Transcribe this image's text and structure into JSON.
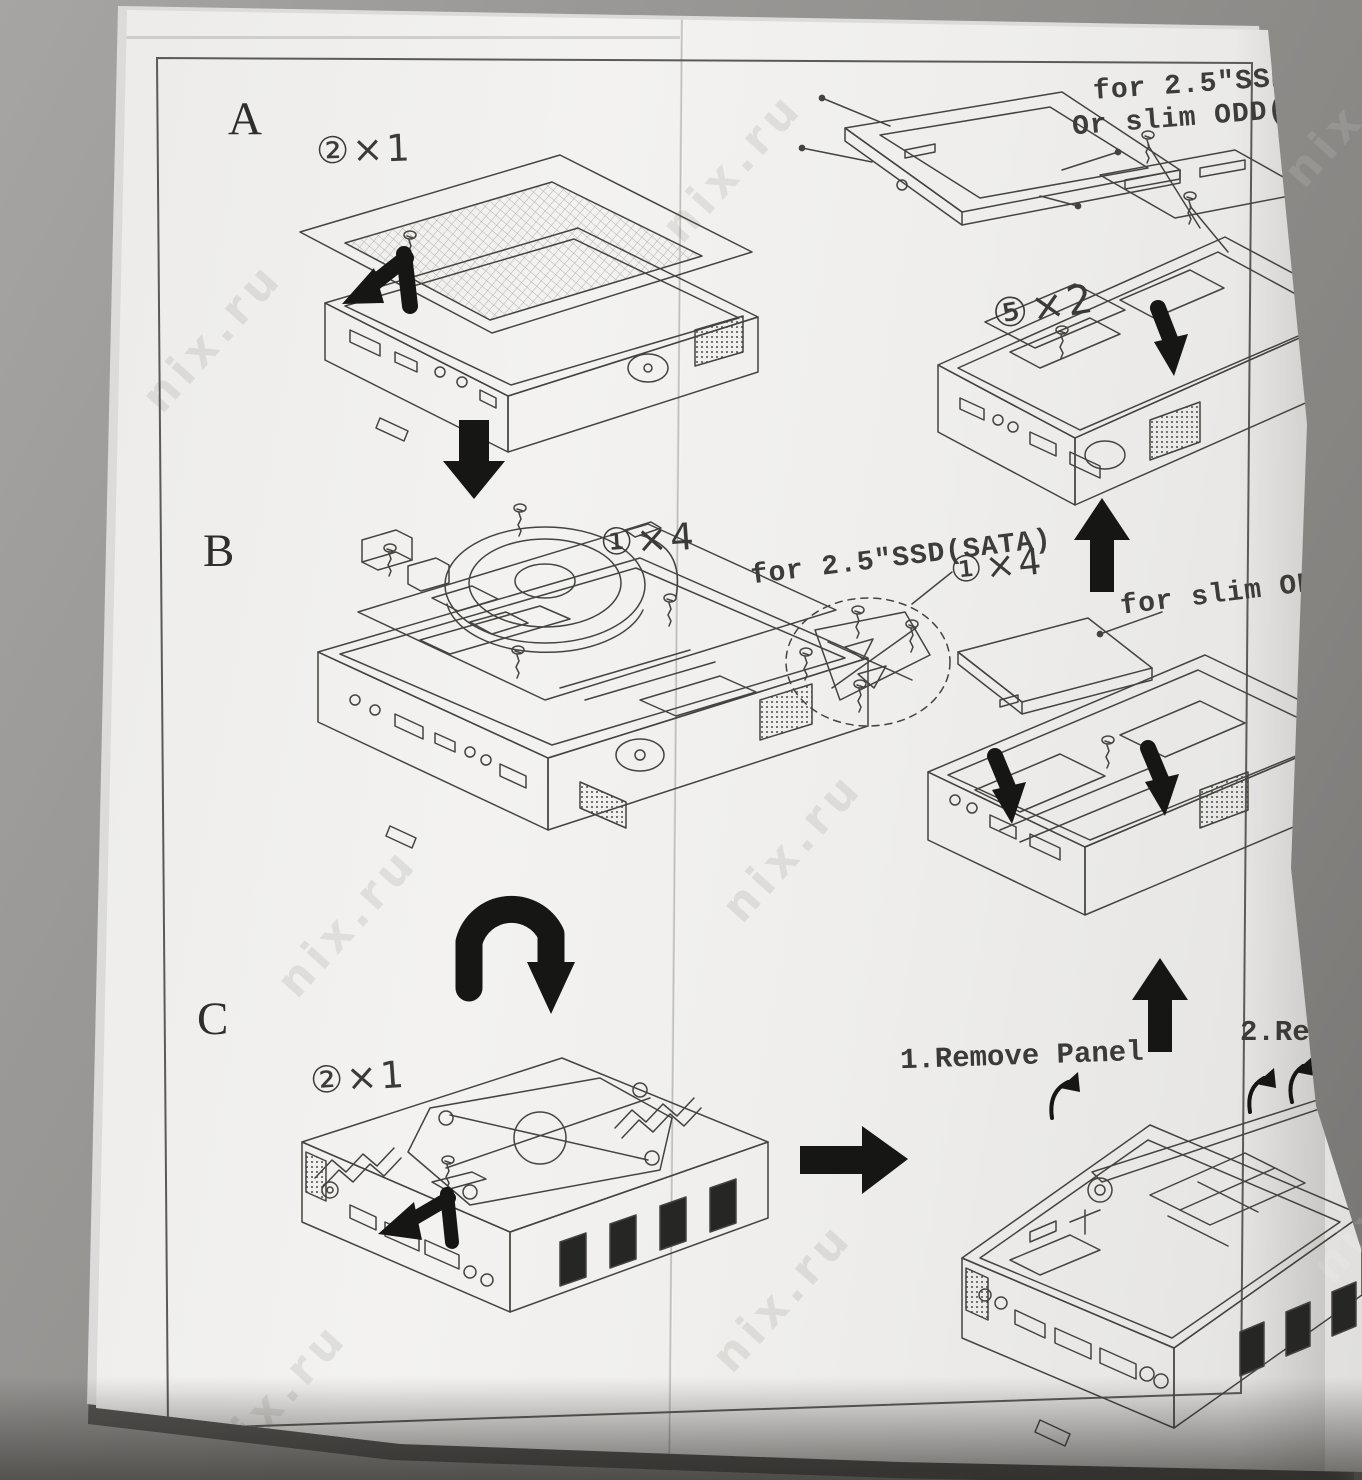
{
  "photo": {
    "background_color": "#918f8c",
    "paper_color": "#f1f0ee",
    "ink_color": "#44443f",
    "arrow_color": "#1a1a18",
    "watermark_text": "nix.ru"
  },
  "sections": {
    "a": {
      "label": "A",
      "qty": "②×1"
    },
    "b": {
      "label": "B",
      "qty": "①×4"
    },
    "c": {
      "label": "C",
      "qty": "②×1"
    }
  },
  "right_column": {
    "drive_note_line1": "for 2.5″SSD",
    "drive_note_line2": "Or slim ODD(",
    "qty_drive_screws": "⑤×2",
    "sata_note": "for 2.5″SSD(SATA)",
    "qty_sata_screws": "①×4",
    "slim_note": "for slim OD",
    "step_1": "1.Remove Panel",
    "step_2": "2.Re"
  }
}
